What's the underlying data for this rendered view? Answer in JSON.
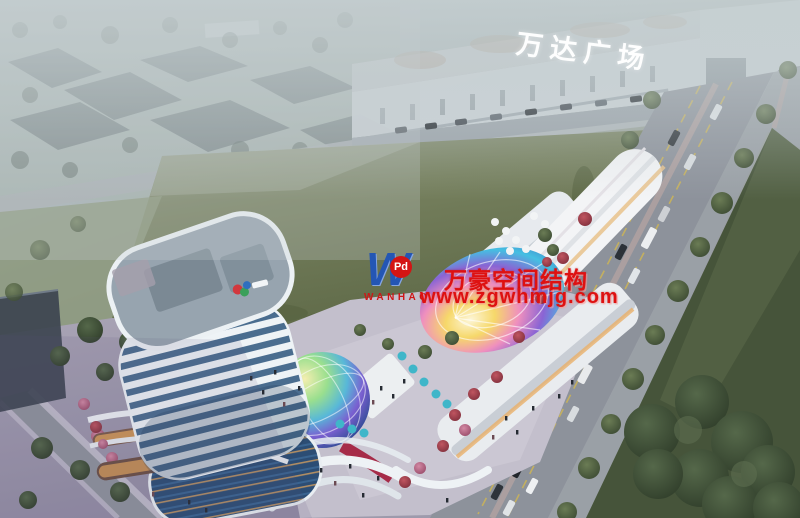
{
  "image": {
    "type": "aerial architectural rendering of a mixed-use commercial complex at dusk",
    "landmarks": [
      "white curved high-rise tower",
      "retail podium with iridescent canopies",
      "Wanda Plaza mall",
      "green field",
      "tree-lined boulevard"
    ]
  },
  "signage": {
    "mall_roof_sign": "万达广场"
  },
  "watermark": {
    "logo_letter": "W",
    "logo_badge": "Pd",
    "logo_name": "WANHAO",
    "title": "万豪空间结构",
    "url": "www.zgwhmjg.com",
    "text_color": "#de1111",
    "logo_blue": "#2456b4"
  },
  "colors": {
    "haze": "#aeb9bd",
    "field_green": "#76805e",
    "lawn_green": "#46543a",
    "road_gray": "#8d929b",
    "tower_white": "#eef2f5",
    "tower_glass": "#4a6d8f",
    "plaza_dusk": "#a49fb3",
    "sign_white": "#ffffff",
    "canopy_cyan": "#45bfe2",
    "canopy_magenta": "#ef8fbe",
    "canopy_yellow": "#f6d86a",
    "canopy_purple": "#8a64d4",
    "umbrella_teal": "#3fb6c9",
    "storefront_glow": "#e8a95c"
  }
}
